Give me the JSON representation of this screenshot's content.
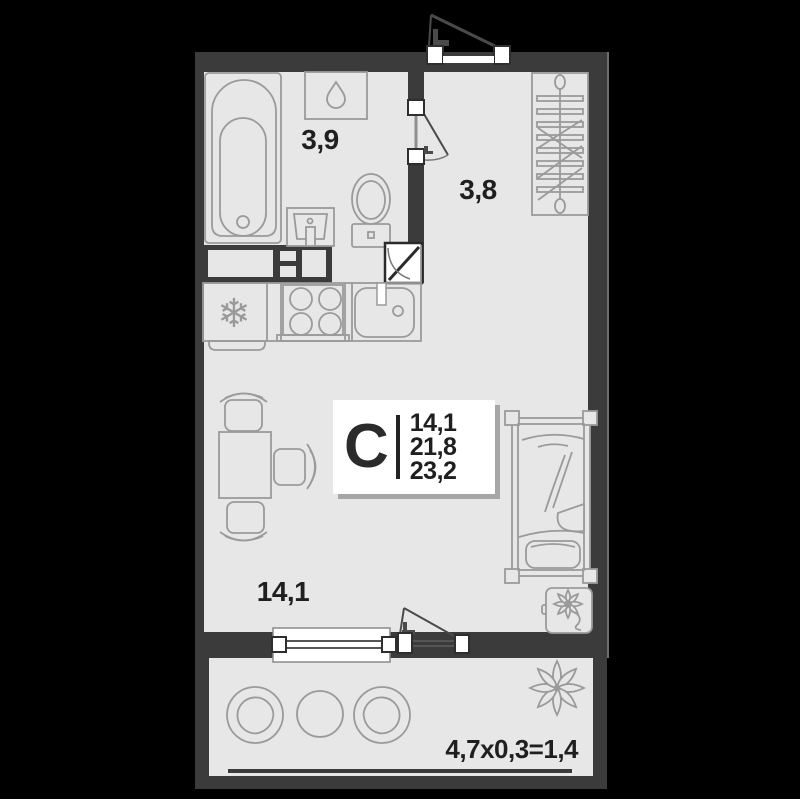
{
  "colors": {
    "background": "#000000",
    "wall": "#3b3b3b",
    "floor": "#e7e7e7",
    "furniture_outline": "#9a9a9a",
    "text": "#1f1f1f",
    "card_bg": "#ffffff"
  },
  "card": {
    "type_letter": "С",
    "living_area": "14,1",
    "area_no_balcony": "21,8",
    "total_area": "23,2"
  },
  "rooms": {
    "bathroom": {
      "area_label": "3,9"
    },
    "hall": {
      "area_label": "3,8"
    },
    "living": {
      "area_label": "14,1"
    }
  },
  "balcony": {
    "area_formula": "4,7x0,3=1,4"
  },
  "icons": {
    "snowflake": "❄"
  }
}
